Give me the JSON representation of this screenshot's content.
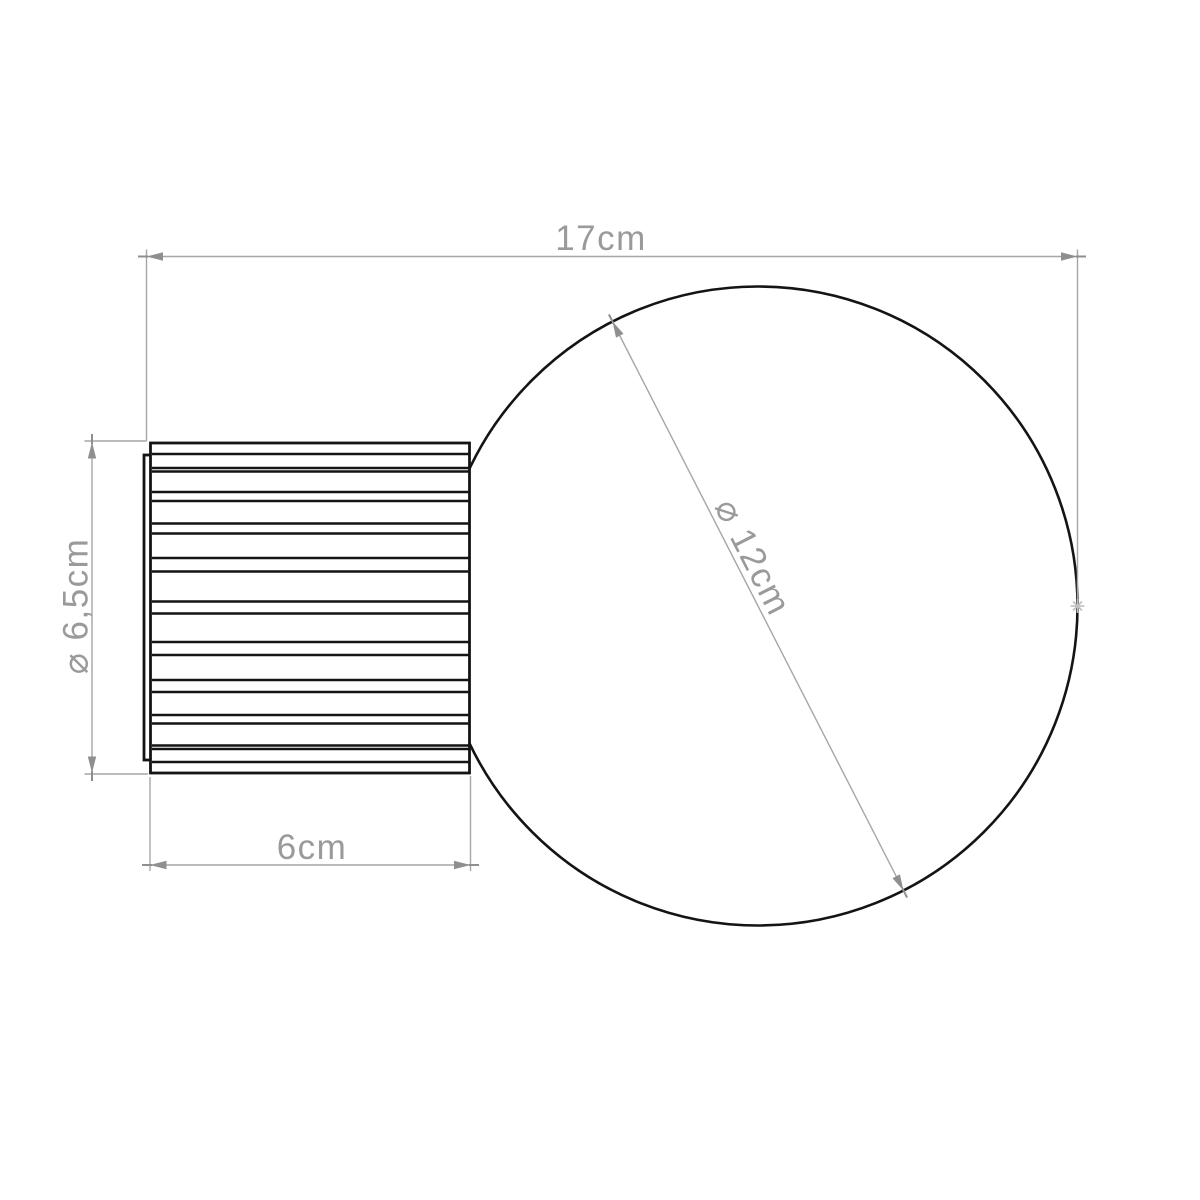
{
  "drawing": {
    "type": "technical-dimension-drawing",
    "object": "wall lamp with globe bulb and ribbed cylindrical base",
    "dimensions": {
      "overall_width": {
        "value": "17cm"
      },
      "base_diameter": {
        "value": "⌀ 6,5cm"
      },
      "base_width": {
        "value": "6cm"
      },
      "globe_diameter": {
        "value": "⌀ 12cm"
      }
    },
    "colors": {
      "background": "#ffffff",
      "object_outline": "#141414",
      "dimension_lines": "#a6a6a6",
      "dimension_text": "#9a9a9a",
      "arrowheads": "#8f8f8f",
      "measure_point_marker": "#bfbfbf"
    }
  }
}
